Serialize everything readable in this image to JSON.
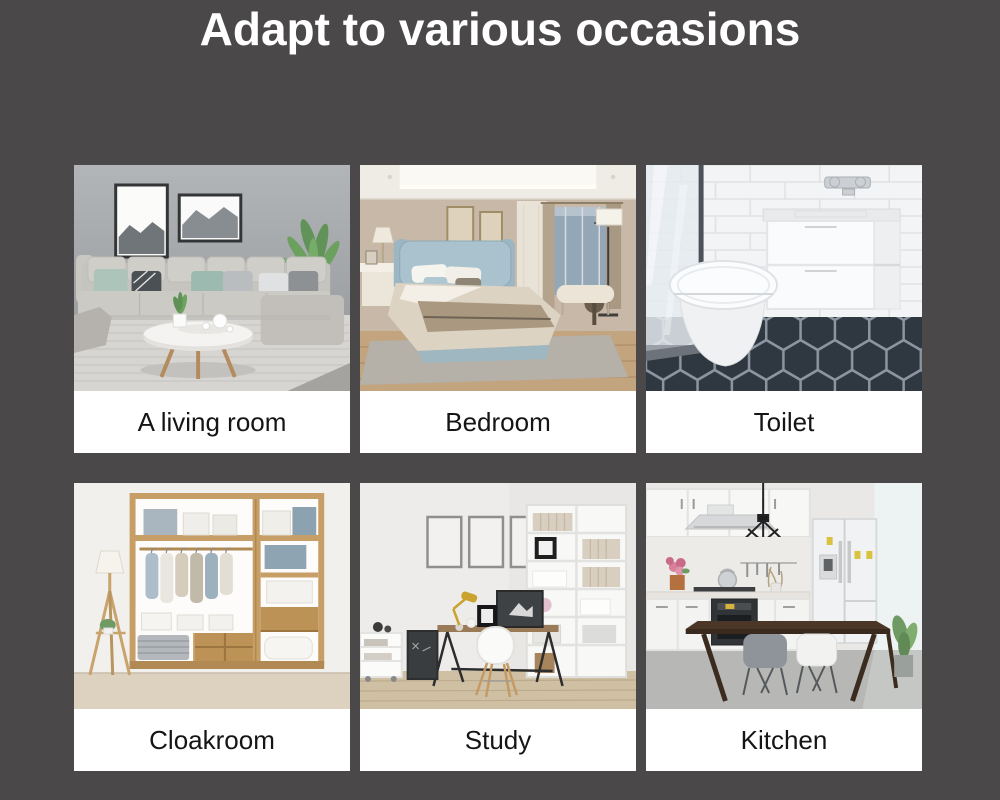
{
  "page": {
    "background_color": "#4a4848"
  },
  "header": {
    "title": "Adapt to various occasions",
    "title_color": "#ffffff"
  },
  "cards": [
    {
      "label": "A living room",
      "photo": "living-room-photo"
    },
    {
      "label": "Bedroom",
      "photo": "bedroom-photo"
    },
    {
      "label": "Toilet",
      "photo": "toilet-photo"
    },
    {
      "label": "Cloakroom",
      "photo": "cloakroom-photo"
    },
    {
      "label": "Study",
      "photo": "study-photo"
    },
    {
      "label": "Kitchen",
      "photo": "kitchen-photo"
    }
  ]
}
